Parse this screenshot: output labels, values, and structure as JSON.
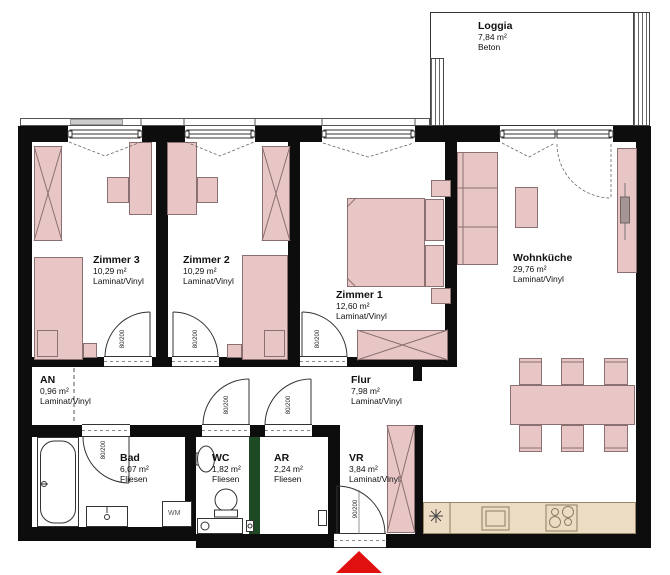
{
  "rooms": {
    "loggia": {
      "name": "Loggia",
      "area": "7,84 m²",
      "floor": "Beton"
    },
    "zimmer3": {
      "name": "Zimmer 3",
      "area": "10,29 m²",
      "floor": "Laminat/Vinyl"
    },
    "zimmer2": {
      "name": "Zimmer 2",
      "area": "10,29 m²",
      "floor": "Laminat/Vinyl"
    },
    "zimmer1": {
      "name": "Zimmer 1",
      "area": "12,60 m²",
      "floor": "Laminat/Vinyl"
    },
    "wohnkueche": {
      "name": "Wohnküche",
      "area": "29,76 m²",
      "floor": "Laminat/Vinyl"
    },
    "an": {
      "name": "AN",
      "area": "0,96 m²",
      "floor": "Laminat/Vinyl"
    },
    "flur": {
      "name": "Flur",
      "area": "7,98 m²",
      "floor": "Laminat/Vinyl"
    },
    "bad": {
      "name": "Bad",
      "area": "6,07 m²",
      "floor": "Fliesen"
    },
    "wc": {
      "name": "WC",
      "area": "1,82 m²",
      "floor": "Fliesen"
    },
    "ar": {
      "name": "AR",
      "area": "2,24 m²",
      "floor": "Fliesen"
    },
    "vr": {
      "name": "VR",
      "area": "3,84 m²",
      "floor": "Laminat/Vinyl"
    }
  },
  "doors": {
    "zimmer3": "80/200",
    "zimmer2": "80/200",
    "zimmer1": "80/200",
    "bad": "80/200",
    "wc": "80/200",
    "ar": "80/200",
    "entrance": "90/200"
  },
  "appliances": {
    "washing_machine": "WM"
  },
  "colors": {
    "wall": "#0d0d0d",
    "furniture": "#e8c6c6",
    "furniture_outline": "#8a7070",
    "kitchen_counter": "#eddcc4",
    "green_wall": "#1d4a25",
    "entrance_marker": "#e01010"
  }
}
